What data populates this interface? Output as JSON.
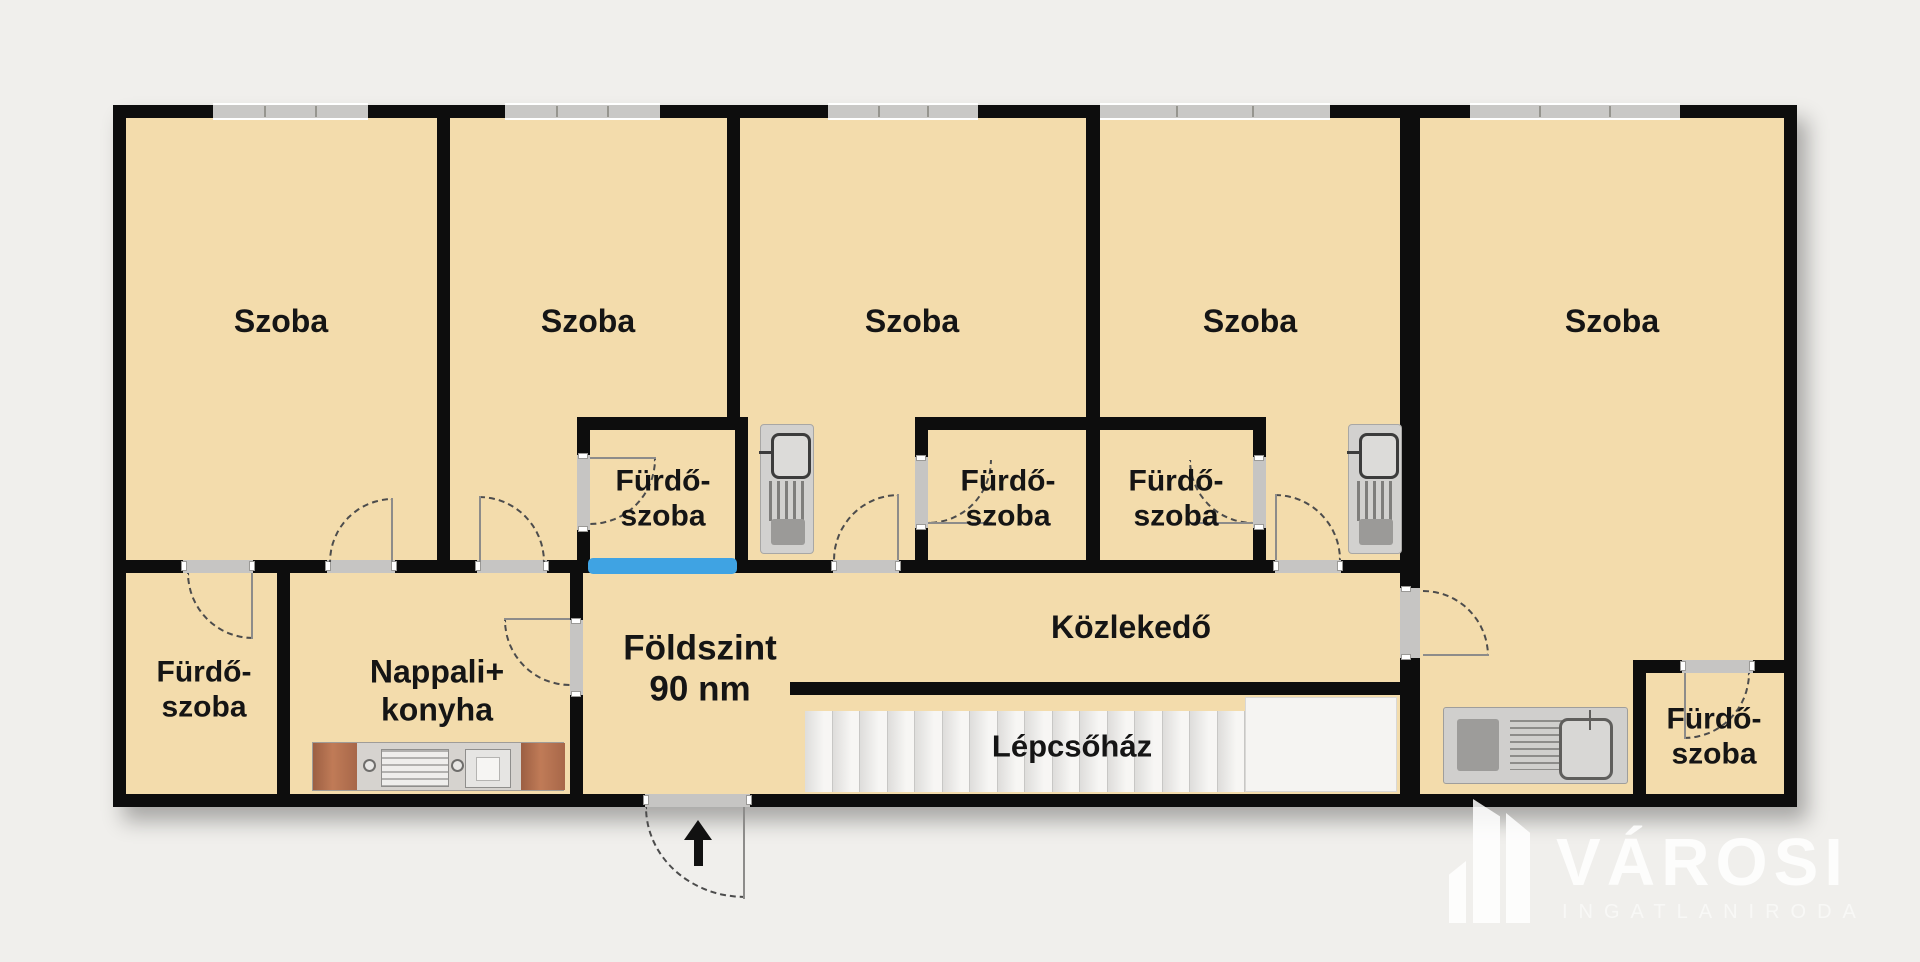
{
  "floorplan": {
    "floor_info": {
      "line1": "Földszint",
      "line2": "90 nm"
    },
    "rooms": [
      {
        "id": "szoba-1",
        "label": "Szoba"
      },
      {
        "id": "szoba-2",
        "label": "Szoba"
      },
      {
        "id": "szoba-3",
        "label": "Szoba"
      },
      {
        "id": "szoba-4",
        "label": "Szoba"
      },
      {
        "id": "szoba-5",
        "label": "Szoba"
      },
      {
        "id": "furdoszoba-bal-also",
        "label_line1": "Fürdő-",
        "label_line2": "szoba"
      },
      {
        "id": "furdoszoba-kozep-a",
        "label_line1": "Fürdő-",
        "label_line2": "szoba"
      },
      {
        "id": "furdoszoba-kozep-b",
        "label_line1": "Fürdő-",
        "label_line2": "szoba"
      },
      {
        "id": "furdoszoba-kozep-c",
        "label_line1": "Fürdő-",
        "label_line2": "szoba"
      },
      {
        "id": "furdoszoba-jobb-also",
        "label_line1": "Fürdő-",
        "label_line2": "szoba"
      },
      {
        "id": "nappali-konyha",
        "label_line1": "Nappali+",
        "label_line2": "konyha"
      },
      {
        "id": "kozlekedo",
        "label": "Közlekedő"
      },
      {
        "id": "lepcsohaz",
        "label": "Lépcsőház"
      }
    ],
    "logo": {
      "brand": "VÁROSI",
      "subtitle": "INGATLANIRODA"
    },
    "colors": {
      "background": "#f0efec",
      "floor": "#f3dcac",
      "wall": "#0d0d0d",
      "window_gray": "#c9c8c6",
      "interior_window_blue": "#3fa3e3",
      "door_gray": "#c6c5c3",
      "cabinet_brown": "#a96748",
      "logo_white": "#ffffff"
    }
  }
}
